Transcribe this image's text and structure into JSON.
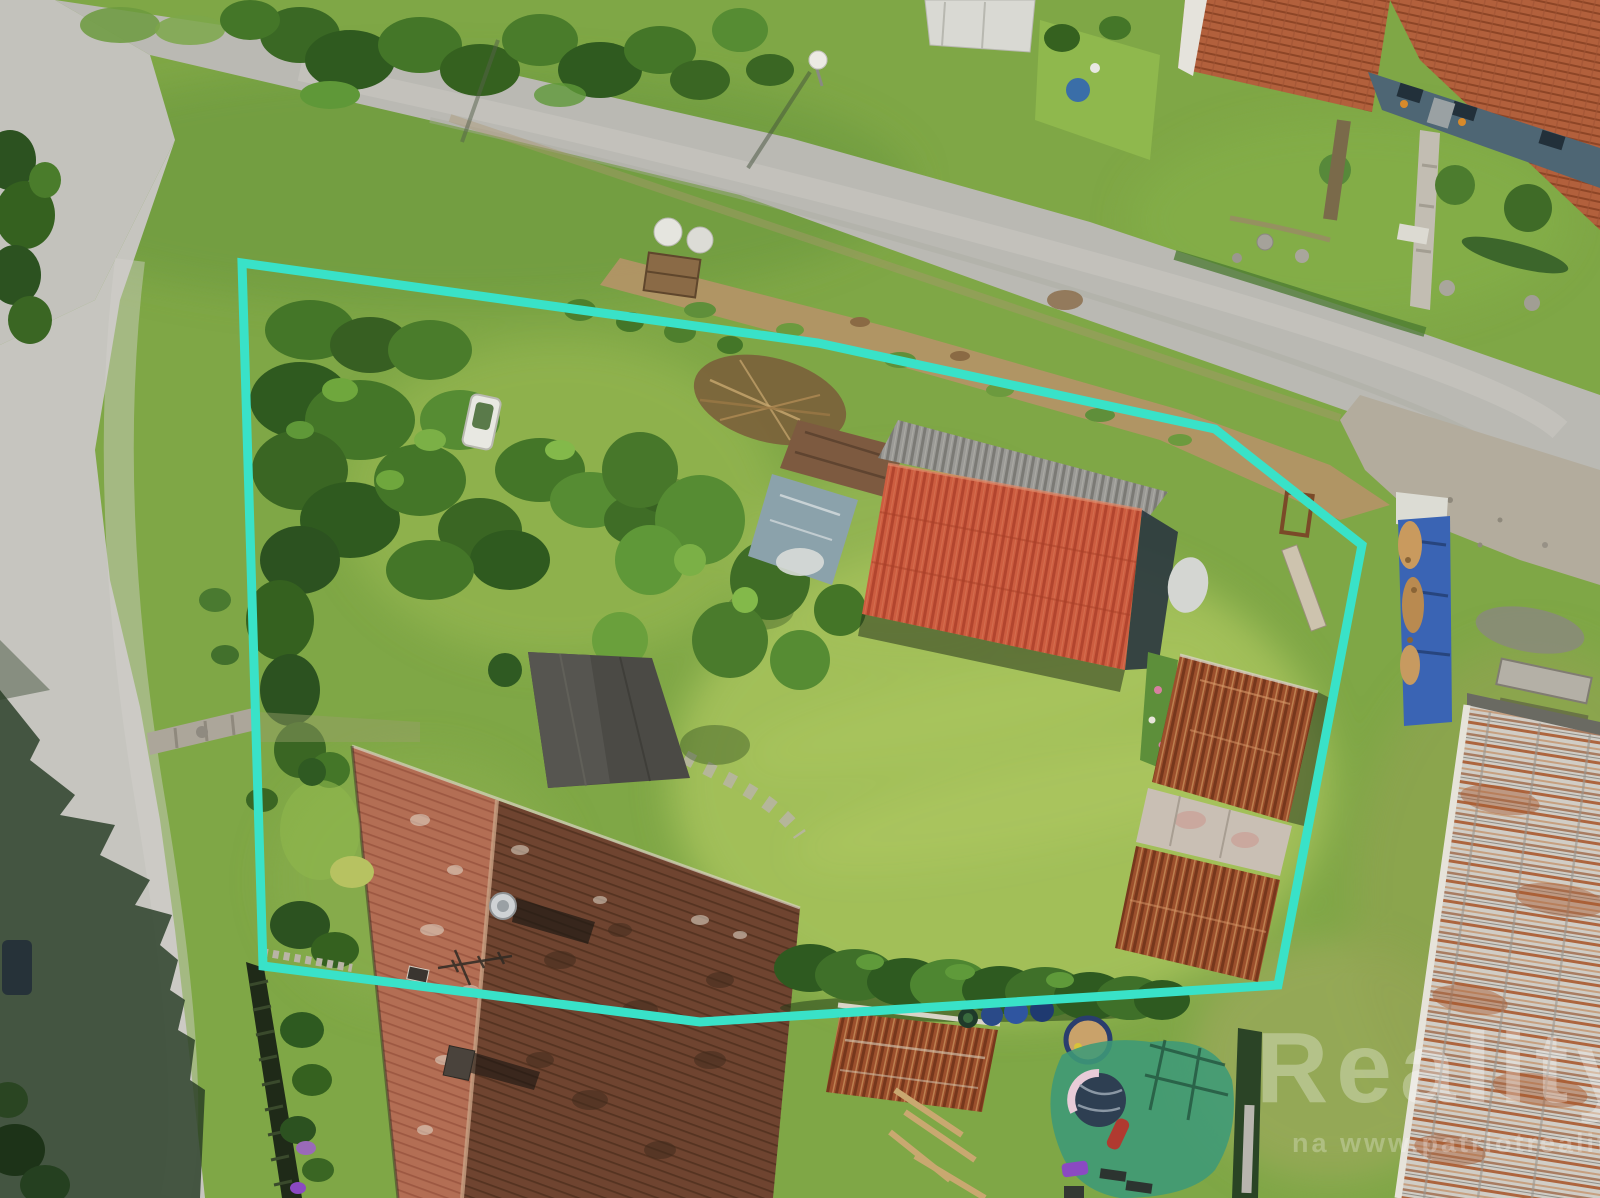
{
  "scene": {
    "description": "Aerial drone photo of a village plot: lawns, orchard shrubs, red-roofed barn, weathered farmhouse roof, sheds, roads, with a turquoise property-boundary outline overlay"
  },
  "boundary": {
    "color": "#39E2C8",
    "points": "242,263 818,343 1215,429 1362,545 1278,985 700,1022 263,966",
    "stroke_width": "9"
  },
  "watermark": {
    "color": "#FFFFFF",
    "brand": "Reality",
    "tagline": "na www.patriotreality.cz"
  },
  "palette": {
    "grass": "#7FA746",
    "road": "#BFBEB8",
    "dirt": "#B49467",
    "barn_roof_red": "#CB5A3E",
    "house_roof_light": "#B06A50",
    "house_roof_dark": "#71452F",
    "rust": "#A34A2A",
    "tarp_blue": "#3A64B4",
    "shade_net_green": "#3E9A78",
    "boundary_accent": "#39E2C8"
  }
}
